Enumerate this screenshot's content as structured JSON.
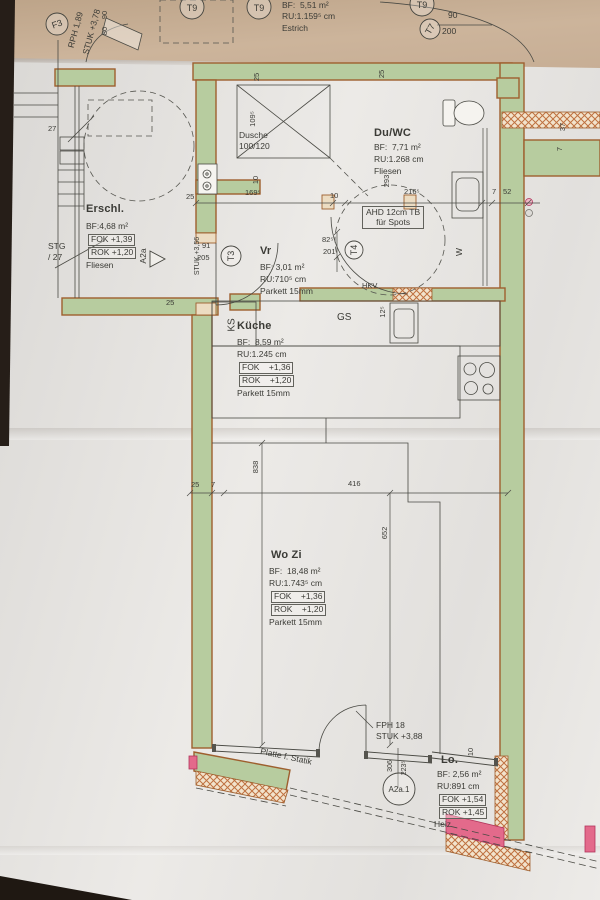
{
  "top_room": {
    "bf": "BF:  5,51 m²",
    "ru": "RU:1.159⁵ cm",
    "floor": "Estrich",
    "door_w": "90",
    "door_h": "200",
    "rph": "RPH 1,89",
    "stuk": "STUK +3,78",
    "n90": "90",
    "n80": "80"
  },
  "erschl": {
    "name": "Erschl.",
    "bf": "BF:4,68 m²",
    "fok": "FOK +1,39",
    "rok": "ROK +1,20",
    "floor": "Fliesen",
    "stg": "STG",
    "stg27": "/ 27",
    "n27": "27"
  },
  "duwc": {
    "name": "Du/WC",
    "bf": "BF:  7,71 m²",
    "ru": "RU:1.268 cm",
    "floor": "Fliesen",
    "ahd1": "AHD 12cm TB",
    "ahd2": "für Spots",
    "w": "W"
  },
  "dusche": {
    "label": "Dusche",
    "size": "100/120"
  },
  "vr": {
    "name": "Vr",
    "bf": "BF: 3,01 m²",
    "ru": "RU:710⁵ cm",
    "floor": "Parkett 15mm",
    "stuk": "STUK +3,56"
  },
  "kueche": {
    "name": "Küche",
    "bf": "BF:  8,59 m²",
    "ru": "RU:1.245 cm",
    "fok": "FOK    +1,36",
    "rok": "ROK    +1,20",
    "floor": "Parkett 15mm",
    "ks": "KS",
    "gs": "GS",
    "hkv": "HKV"
  },
  "wozi": {
    "name": "Wo Zi",
    "bf": "BF:  18,48 m²",
    "ru": "RU:1.743⁵ cm",
    "fok": "FOK    +1,36",
    "rok": "ROK    +1,20",
    "floor": "Parkett 15mm",
    "fph": "FPH 18",
    "stuk": "STUK +3,88"
  },
  "lo": {
    "name": "Lo.",
    "bf": "BF: 2,56 m²",
    "ru": "RU:891 cm",
    "fok": "FOK +1,54",
    "rok": "ROK +1,45",
    "heiz": "Heiz",
    "platte": "Platte f. Statik"
  },
  "markers": {
    "f3": "F3",
    "t9": "T9",
    "t7": "T7",
    "t3": "T3",
    "t4": "T4",
    "a2a": "A2a",
    "a2a1": "A2a.1"
  },
  "dims": {
    "d25": "25",
    "d7": "7",
    "d10": "10",
    "d37": "37",
    "d52": "52",
    "d91": "91",
    "d205": "205",
    "d169": "169⁵",
    "d82": "82⁵",
    "d201": "201",
    "d293": "293",
    "d216": "216⁵",
    "d109": "109⁵",
    "d12": "12⁵",
    "d416": "416",
    "d838": "838",
    "d652": "652",
    "d306": "306",
    "d223": "223⁵"
  }
}
